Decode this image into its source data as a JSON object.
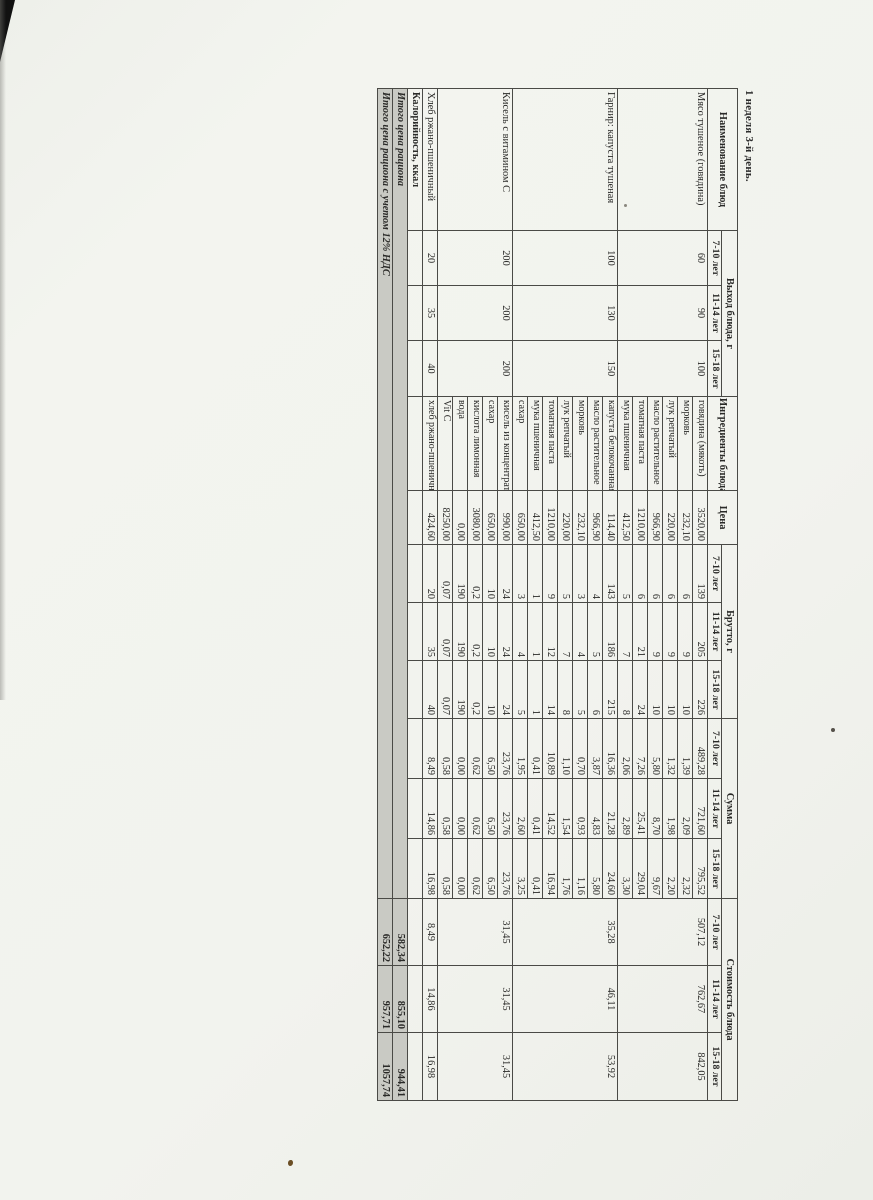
{
  "page": {
    "title": "1 неделя 3-й день."
  },
  "table": {
    "headers": {
      "dish": "Наименование блюд",
      "output": "Выход блюда, г",
      "ingredients": "Ингредиенты блюда",
      "price": "Цена",
      "brutto": "Брутто, г",
      "sum": "Сумма",
      "cost": "Стоимость блюда",
      "age_groups": [
        "7-10 лет",
        "11-14 лет",
        "15-18 лет"
      ]
    },
    "dishes": [
      {
        "name": "Мясо тушеное (говядина)",
        "output": [
          "60",
          "90",
          "100"
        ],
        "cost": [
          "507,12",
          "762,67",
          "842,05"
        ],
        "ingredients": [
          {
            "name": "говядина (мякоть)",
            "price": "3520,00",
            "brutto": [
              "139",
              "205",
              "226"
            ],
            "sum": [
              "489,28",
              "721,60",
              "795,52"
            ]
          },
          {
            "name": "морковь",
            "price": "232,10",
            "brutto": [
              "6",
              "9",
              "10"
            ],
            "sum": [
              "1,39",
              "2,09",
              "2,32"
            ]
          },
          {
            "name": "лук репчатый",
            "price": "220,00",
            "brutto": [
              "6",
              "9",
              "10"
            ],
            "sum": [
              "1,32",
              "1,98",
              "2,20"
            ]
          },
          {
            "name": "масло растительное",
            "price": "966,90",
            "brutto": [
              "6",
              "9",
              "10"
            ],
            "sum": [
              "5,80",
              "8,70",
              "9,67"
            ]
          },
          {
            "name": "томатная паста",
            "price": "1210,00",
            "brutto": [
              "6",
              "21",
              "24"
            ],
            "sum": [
              "7,26",
              "25,41",
              "29,04"
            ]
          },
          {
            "name": "мука пшеничная",
            "price": "412,50",
            "brutto": [
              "5",
              "7",
              "8"
            ],
            "sum": [
              "2,06",
              "2,89",
              "3,30"
            ]
          }
        ]
      },
      {
        "name": "Гарнир: капуста тушеная",
        "output": [
          "100",
          "130",
          "150"
        ],
        "cost": [
          "35,28",
          "46,11",
          "53,92"
        ],
        "ingredients": [
          {
            "name": "капуста белокочанная",
            "price": "114,40",
            "brutto": [
              "143",
              "186",
              "215"
            ],
            "sum": [
              "16,36",
              "21,28",
              "24,60"
            ]
          },
          {
            "name": "масло растительное",
            "price": "966,90",
            "brutto": [
              "4",
              "5",
              "6"
            ],
            "sum": [
              "3,87",
              "4,83",
              "5,80"
            ]
          },
          {
            "name": "морковь",
            "price": "232,10",
            "brutto": [
              "3",
              "4",
              "5"
            ],
            "sum": [
              "0,70",
              "0,93",
              "1,16"
            ]
          },
          {
            "name": "лук репчатый",
            "price": "220,00",
            "brutto": [
              "5",
              "7",
              "8"
            ],
            "sum": [
              "1,10",
              "1,54",
              "1,76"
            ]
          },
          {
            "name": "томатная паста",
            "price": "1210,00",
            "brutto": [
              "9",
              "12",
              "14"
            ],
            "sum": [
              "10,89",
              "14,52",
              "16,94"
            ]
          },
          {
            "name": "мука пшеничная",
            "price": "412,50",
            "brutto": [
              "1",
              "1",
              "1"
            ],
            "sum": [
              "0,41",
              "0,41",
              "0,41"
            ]
          },
          {
            "name": "сахар",
            "price": "650,00",
            "brutto": [
              "3",
              "4",
              "5"
            ],
            "sum": [
              "1,95",
              "2,60",
              "3,25"
            ]
          }
        ]
      },
      {
        "name": "Кисель с витамином С",
        "output": [
          "200",
          "200",
          "200"
        ],
        "cost": [
          "31,45",
          "31,45",
          "31,45"
        ],
        "ingredients": [
          {
            "name": "кисель из концентрата",
            "price": "990,00",
            "brutto": [
              "24",
              "24",
              "24"
            ],
            "sum": [
              "23,76",
              "23,76",
              "23,76"
            ]
          },
          {
            "name": "сахар",
            "price": "650,00",
            "brutto": [
              "10",
              "10",
              "10"
            ],
            "sum": [
              "6,50",
              "6,50",
              "6,50"
            ]
          },
          {
            "name": "кислота лимонная",
            "price": "3080,00",
            "brutto": [
              "0,2",
              "0,2",
              "0,2"
            ],
            "sum": [
              "0,62",
              "0,62",
              "0,62"
            ]
          },
          {
            "name": "вода",
            "price": "0,00",
            "brutto": [
              "190",
              "190",
              "190"
            ],
            "sum": [
              "0,00",
              "0,00",
              "0,00"
            ]
          },
          {
            "name": "Vit C",
            "price": "8250,00",
            "brutto": [
              "0,07",
              "0,07",
              "0,07"
            ],
            "sum": [
              "0,58",
              "0,58",
              "0,58"
            ]
          }
        ]
      },
      {
        "name": "Хлеб ржано-пшеничный",
        "output": [
          "20",
          "35",
          "40"
        ],
        "cost": [
          "8,49",
          "14,86",
          "16,98"
        ],
        "ingredients": [
          {
            "name": "хлеб ржано-пшеничный",
            "price": "424,60",
            "brutto": [
              "20",
              "35",
              "40"
            ],
            "sum": [
              "8,49",
              "14,86",
              "16,98"
            ]
          }
        ]
      }
    ],
    "footer_rows": [
      {
        "label": "Калорийность, ккал",
        "values": [
          "",
          "",
          ""
        ],
        "shaded": false,
        "italic": false,
        "span_label": false
      },
      {
        "label": "Итого цена рациона",
        "values": [
          "582,34",
          "855,10",
          "944,41"
        ],
        "shaded": true,
        "italic": true,
        "span_label": true
      },
      {
        "label": "Итого цена рациона с учетом 12% НДС",
        "values": [
          "652,22",
          "957,71",
          "1057,74"
        ],
        "shaded": true,
        "italic": true,
        "span_label": true
      }
    ]
  }
}
